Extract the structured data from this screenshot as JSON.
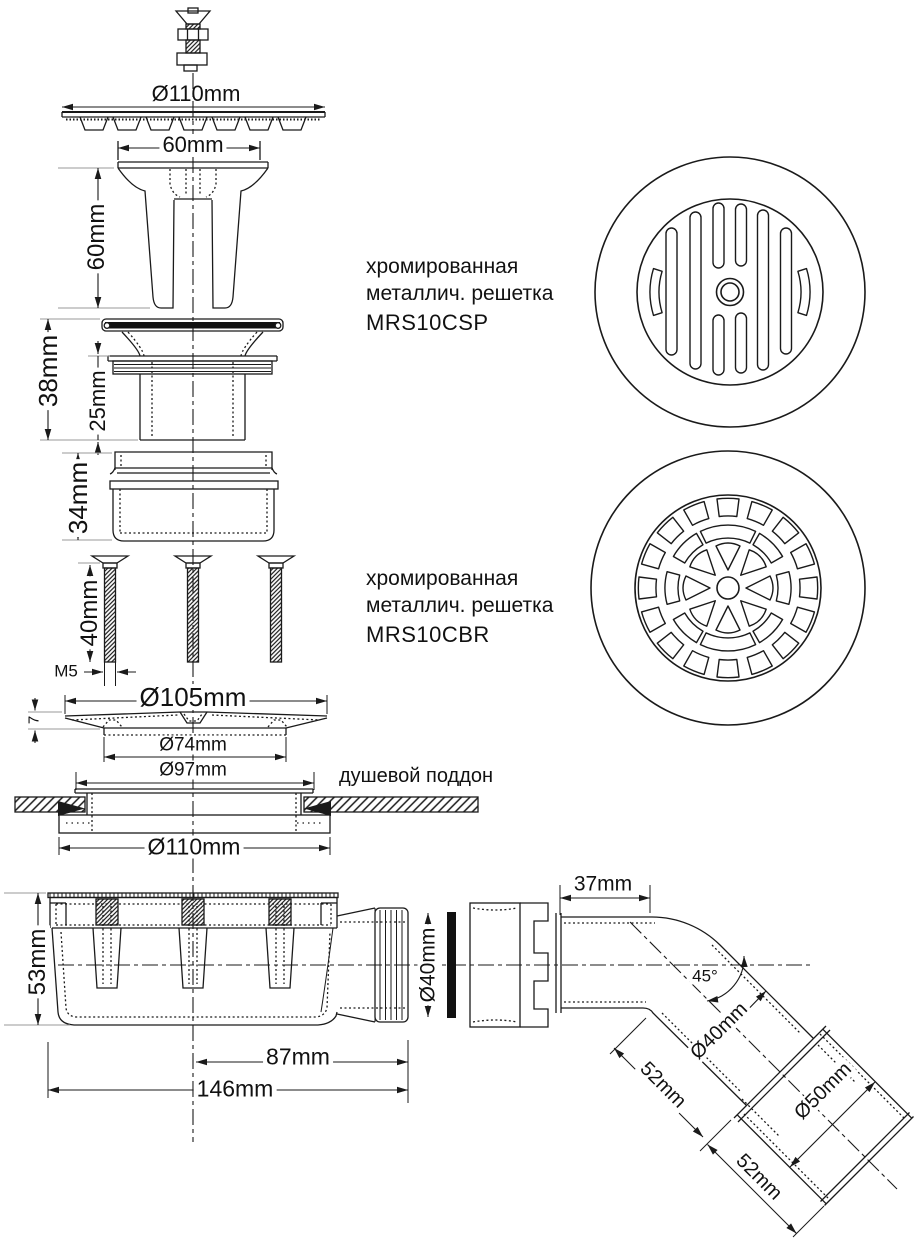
{
  "drawing": {
    "type": "shower-drain-assembly-technical-drawing",
    "ink_color": "#1a1a1a",
    "background": "#ffffff"
  },
  "dimensions": {
    "grate_diameter_top": "Ø110mm",
    "funnel_width": "60mm",
    "funnel_height": "60mm",
    "flange_height": "38mm",
    "flange_tube_height": "25mm",
    "ring_height": "34mm",
    "screw_length": "40mm",
    "screw_thread": "M5",
    "plate_diameter": "Ø105mm",
    "plate_thickness": "7",
    "plate_inner_diameter": "Ø74mm",
    "plate_neck_diameter": "Ø97mm",
    "bottom_flange_diameter": "Ø110mm",
    "body_height": "53mm",
    "outlet_diameter": "Ø40mm",
    "outlet_offset": "87mm",
    "body_length": "146mm",
    "elbow_inlet_length": "37mm",
    "elbow_angle": "45°",
    "elbow_pipe_diameter": "Ø40mm",
    "elbow_pipe_length": "52mm",
    "elbow_socket_diameter": "Ø50mm",
    "elbow_socket_length": "52mm"
  },
  "annotations": {
    "shower_tray": "душевой поддон"
  },
  "products": [
    {
      "line1": "хромированная",
      "line2": "металлич. решетка",
      "code": "MRS10CSP"
    },
    {
      "line1": "хромированная",
      "line2": "металлич. решетка",
      "code": "MRS10CBR"
    }
  ]
}
